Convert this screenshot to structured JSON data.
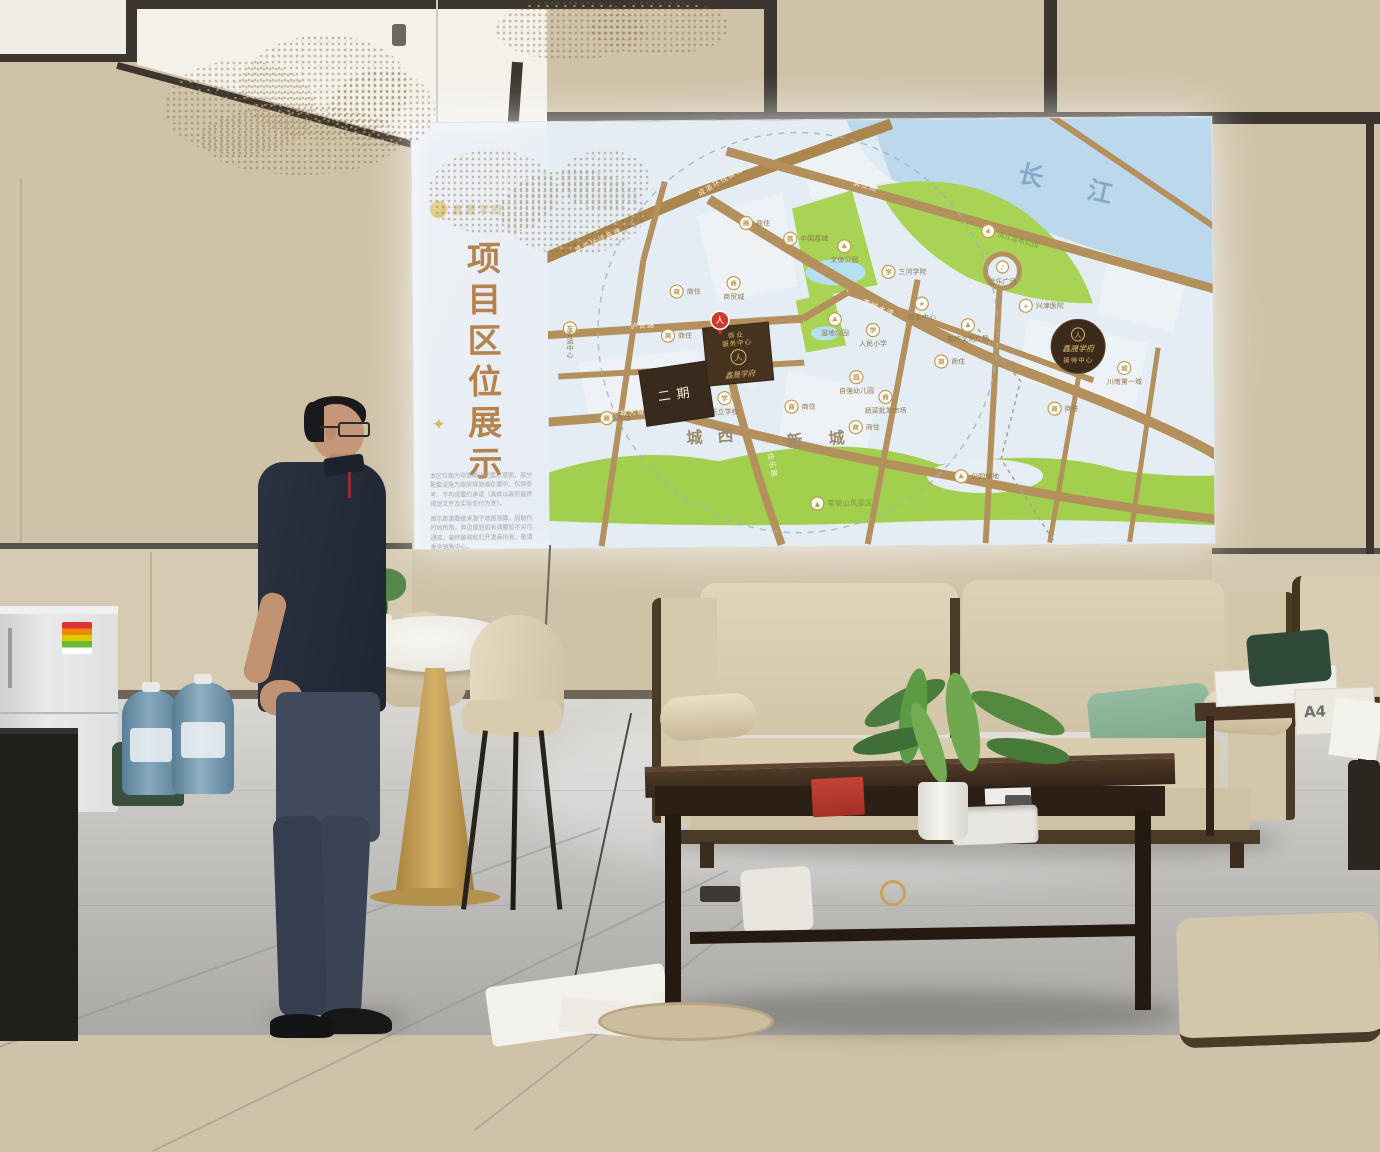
{
  "screen": {
    "logo_text": "鑫晟学府",
    "title": "项目区位展示",
    "sparkle": "✦",
    "fine_print": {
      "p1": "本区位图为项目周边配套示意图，部分配套设施为政府规划或在建中，仅供参考，不构成要约承诺（具体以政府最终规划文件及实际交付为准）。",
      "p2": "图示距离数据来源于地图测算，因制作时间所限，周边规划如有调整恕不另行通知，最终解释权归开发商所有，敬请垂询销售中心。"
    },
    "map": {
      "river": "长江",
      "districts": {
        "west": "城西",
        "new": "新城"
      },
      "roads": {
        "expressway": "成渝环线高速",
        "binjiang": "滨江路",
        "licheng": "荔城大道",
        "luhe": "泸合路",
        "qiaole": "侨乐路",
        "jiale": "佳乐路",
        "chancheng": "产城大道"
      },
      "project": {
        "pin_glyph": "人",
        "block_line1": "商业",
        "block_line2": "服务中心",
        "name": "鑫晟学府",
        "phase2": "二期",
        "reception_line1": "鑫晟学府",
        "reception_line2": "接待中心"
      },
      "pois": [
        {
          "glyph": "商",
          "label": "商住"
        },
        {
          "glyph": "荔",
          "label": "中国荔城"
        },
        {
          "glyph": "♣",
          "label": "文体公园"
        },
        {
          "glyph": "学",
          "label": "三河学院"
        },
        {
          "glyph": "★",
          "label": "政务中心"
        },
        {
          "glyph": "+",
          "label": "兴津医院"
        },
        {
          "glyph": "♣",
          "label": "荔枝文化广场"
        },
        {
          "glyph": "♪",
          "label": "音乐广场"
        },
        {
          "glyph": "♣",
          "label": "滨江湿地公园"
        },
        {
          "glyph": "城",
          "label": "川南第一城"
        },
        {
          "glyph": "学",
          "label": "人民小学"
        },
        {
          "glyph": "♣",
          "label": "湿地公园"
        },
        {
          "glyph": "园",
          "label": "自强幼儿园"
        },
        {
          "glyph": "商",
          "label": "蔬菜批发市场"
        },
        {
          "glyph": "学",
          "label": "天立学校"
        },
        {
          "glyph": "车",
          "label": "客运中心"
        },
        {
          "glyph": "商",
          "label": "商贸城"
        },
        {
          "glyph": "商",
          "label": "商住"
        },
        {
          "glyph": "商",
          "label": "商住"
        },
        {
          "glyph": "商",
          "label": "商住"
        },
        {
          "glyph": "商",
          "label": "商住"
        },
        {
          "glyph": "商",
          "label": "商住"
        },
        {
          "glyph": "商",
          "label": "商住"
        },
        {
          "glyph": "商",
          "label": "商住"
        },
        {
          "glyph": "▲",
          "label": "笔架山风景区"
        },
        {
          "glyph": "♣",
          "label": "公园绿地"
        }
      ]
    }
  },
  "room": {
    "paper_box_label": "A4"
  }
}
